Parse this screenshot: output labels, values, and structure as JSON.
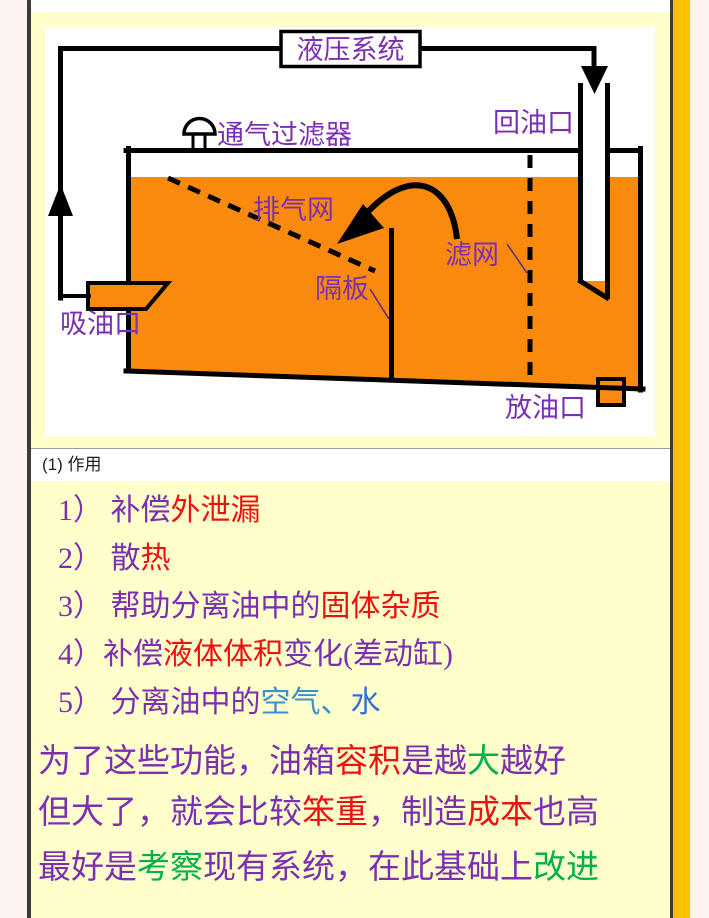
{
  "colors": {
    "outer_background": "#FDF3F1",
    "slide_background": "#FFFFCC",
    "gold_strip": "#FCC101",
    "dark_border": "#3B3B38",
    "oil_orange": "#FA8A0D",
    "label_purple": "#7B2FB2",
    "text_red": "#EE1111",
    "text_green": "#00B050",
    "text_blue_air": "#3E8FD0",
    "text_blue_water": "#2F6FD6"
  },
  "diagram": {
    "labels": {
      "system_box": "液压系统",
      "vent_filter": "通气过滤器",
      "return_port": "回油口",
      "exhaust_mesh": "排气网",
      "filter_mesh": "滤网",
      "baffle": "隔板",
      "suction_port": "吸油口",
      "drain_port": "放油口"
    }
  },
  "heading": {
    "text": "(1) 作用"
  },
  "functions_list": {
    "items": [
      {
        "segments": [
          {
            "t": "1） 补偿",
            "c": "purple"
          },
          {
            "t": "外泄漏",
            "c": "red"
          }
        ]
      },
      {
        "segments": [
          {
            "t": "2） 散",
            "c": "purple"
          },
          {
            "t": "热",
            "c": "red"
          }
        ]
      },
      {
        "segments": [
          {
            "t": "3） 帮助分离油中的",
            "c": "purple"
          },
          {
            "t": "固体杂质",
            "c": "red"
          }
        ]
      },
      {
        "segments": [
          {
            "t": "4）补偿",
            "c": "purple"
          },
          {
            "t": "液体体积",
            "c": "red"
          },
          {
            "t": "变化(差动缸)",
            "c": "purple"
          }
        ]
      },
      {
        "segments": [
          {
            "t": "5） 分离油中的",
            "c": "purple"
          },
          {
            "t": "空气、",
            "c": "blue1"
          },
          {
            "t": "水",
            "c": "blue2"
          }
        ]
      }
    ]
  },
  "notes": {
    "lines": [
      {
        "segments": [
          {
            "t": "为了这些功能，油箱",
            "c": "purple"
          },
          {
            "t": "容积",
            "c": "red"
          },
          {
            "t": "是越",
            "c": "purple"
          },
          {
            "t": "大",
            "c": "green"
          },
          {
            "t": "越好",
            "c": "purple"
          }
        ]
      },
      {
        "segments": [
          {
            "t": "但大了，就会比较",
            "c": "purple"
          },
          {
            "t": "笨重",
            "c": "red"
          },
          {
            "t": "，制造",
            "c": "purple"
          },
          {
            "t": "成本",
            "c": "red"
          },
          {
            "t": "也高",
            "c": "purple"
          }
        ]
      },
      {
        "segments": [
          {
            "t": "最好是",
            "c": "purple"
          },
          {
            "t": "考察",
            "c": "green"
          },
          {
            "t": "现有系统，在此基础上",
            "c": "purple"
          },
          {
            "t": "改进",
            "c": "green"
          }
        ]
      }
    ]
  }
}
